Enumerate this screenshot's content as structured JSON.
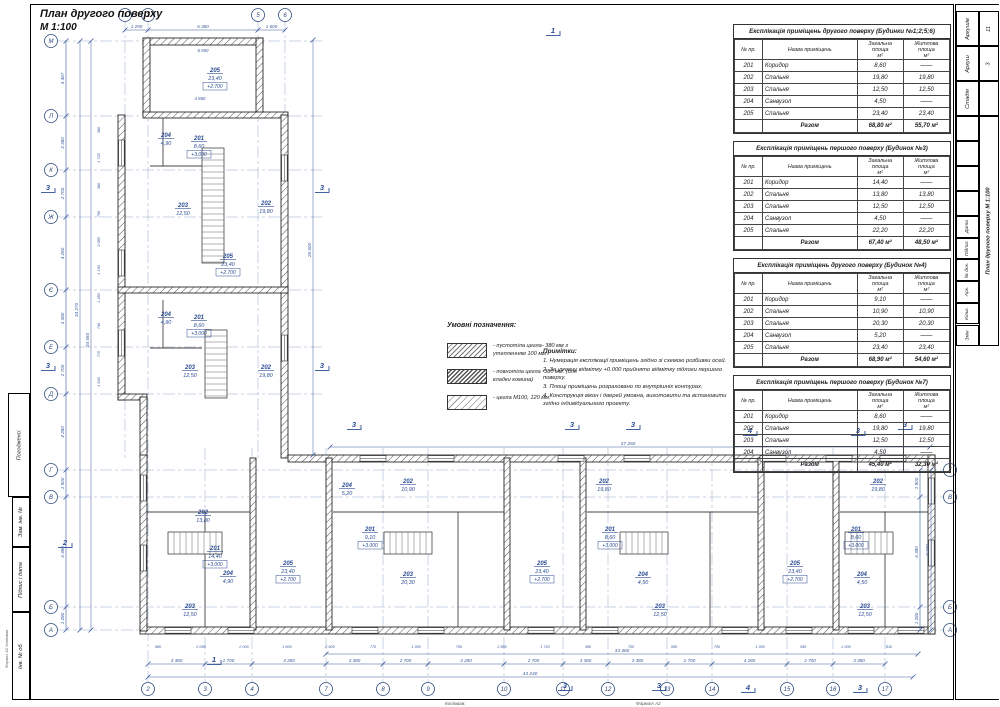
{
  "sheet": {
    "title": "План другого поверху",
    "scale": "М 1:100"
  },
  "accent_colors": {
    "annotation_blue": "#3a5b9e",
    "wall_black": "#111111"
  },
  "tables": [
    {
      "title": "Експлікація приміщень другого поверху (Будинки №1;2;5;6)",
      "headers": [
        "№ пр.",
        "Назва приміщень",
        "Загальна площа\nм²",
        "Житлова площа\nм²"
      ],
      "rows": [
        [
          "201",
          "Коридор",
          "8,60",
          "——"
        ],
        [
          "202",
          "Спальня",
          "19,80",
          "19,80"
        ],
        [
          "203",
          "Спальня",
          "12,50",
          "12,50"
        ],
        [
          "204",
          "Санвузол",
          "4,50",
          "——"
        ],
        [
          "205",
          "Спальня",
          "23,40",
          "23,40"
        ]
      ],
      "total": [
        "",
        "Разом",
        "68,80 м²",
        "55,70 м²"
      ]
    },
    {
      "title": "Експлікація приміщень першого поверху (Будинок №3)",
      "headers": [
        "№ пр.",
        "Назва приміщень",
        "Загальна площа\nм²",
        "Житлова площа\nм²"
      ],
      "rows": [
        [
          "201",
          "Коридор",
          "14,40",
          "——"
        ],
        [
          "202",
          "Спальня",
          "13,80",
          "13,80"
        ],
        [
          "203",
          "Спальня",
          "12,50",
          "12,50"
        ],
        [
          "204",
          "Санвузол",
          "4,50",
          "——"
        ],
        [
          "205",
          "Спальня",
          "22,20",
          "22,20"
        ]
      ],
      "total": [
        "",
        "Разом",
        "67,40 м²",
        "48,50 м²"
      ]
    },
    {
      "title": "Експлікація приміщень другого поверху (Будинок №4)",
      "headers": [
        "№ пр.",
        "Назва приміщень",
        "Загальна площа\nм²",
        "Житлова площа\nм²"
      ],
      "rows": [
        [
          "201",
          "Коридор",
          "9,10",
          "——"
        ],
        [
          "202",
          "Спальня",
          "10,90",
          "10,90"
        ],
        [
          "203",
          "Спальня",
          "20,30",
          "20,30"
        ],
        [
          "204",
          "Санвузол",
          "5,20",
          "——"
        ],
        [
          "205",
          "Спальня",
          "23,40",
          "23,40"
        ]
      ],
      "total": [
        "",
        "Разом",
        "68,90 м²",
        "54,60 м²"
      ]
    },
    {
      "title": "Експлікація приміщень першого поверху (Будинок №7)",
      "headers": [
        "№ пр.",
        "Назва приміщень",
        "Загальна площа\nм²",
        "Житлова площа\nм²"
      ],
      "rows": [
        [
          "201",
          "Коридор",
          "8,60",
          "——"
        ],
        [
          "202",
          "Спальня",
          "19,80",
          "19,80"
        ],
        [
          "203",
          "Спальня",
          "12,50",
          "12,50"
        ],
        [
          "204",
          "Санвузол",
          "4,50",
          "——"
        ]
      ],
      "total": [
        "",
        "Разом",
        "45,40 м²",
        "32,30 м²"
      ]
    }
  ],
  "legend": {
    "title": "Умовні позначення:",
    "items": [
      "- пустотіла цегла- 380 мм з утепленням 100 мм",
      "- повнотіла цегла -380 мм. (для кладки комина)",
      "- цегла М100, 120 мм."
    ]
  },
  "notes": {
    "title": "Примітки:",
    "items": [
      "1. Нумерація експлікації приміщень згідно зі схемою розбивки осей.",
      "2. За умовну відмітку +0.000 прийнято відмітку підлоги першого поверху.",
      "3. Площі приміщень розраховано по внутрішніх контурах.",
      "4. Конструкція вікон і дверей умовна, виготовити та встановити згідно індивідуального проекту."
    ]
  },
  "titleblock_right": {
    "stage_label": "Стадія",
    "sheet_label": "Аркуш",
    "sheets_label": "Аркушів",
    "stage": "",
    "sheet": "3",
    "sheets": "11",
    "title": "План другого поверху  М 1:100",
    "cols": [
      "Дата",
      "Підпис",
      "№ док.",
      "Арк.",
      "Кільк.",
      "Змін"
    ]
  },
  "titleblock_left": {
    "approved": "Погоджено:",
    "zam_inv": "Зам. інв. №",
    "sign_date": "Підпис і дата",
    "inv_ob": "Інв. № об.",
    "format_note": "Формат А2    Копіював"
  },
  "footer": {
    "copied": "Копіював:",
    "format": "Формат А2"
  },
  "plan": {
    "bubbles_top": [
      [
        "1",
        125
      ],
      [
        "2",
        148
      ],
      [
        "5",
        258
      ],
      [
        "6",
        285
      ]
    ],
    "bubbles_bottom": [
      [
        "2",
        148
      ],
      [
        "3",
        205
      ],
      [
        "4",
        252
      ],
      [
        "7",
        326
      ],
      [
        "8",
        383
      ],
      [
        "9",
        428
      ],
      [
        "10",
        504
      ],
      [
        "11",
        563
      ],
      [
        "12",
        608
      ],
      [
        "13",
        667
      ],
      [
        "14",
        712
      ],
      [
        "15",
        787
      ],
      [
        "16",
        833
      ],
      [
        "17",
        885
      ]
    ],
    "bubbles_left": [
      [
        "М",
        41
      ],
      [
        "Л",
        116
      ],
      [
        "К",
        170
      ],
      [
        "Ж",
        217
      ],
      [
        "Є",
        290
      ],
      [
        "Е",
        347
      ],
      [
        "Д",
        394
      ],
      [
        "Г",
        470
      ],
      [
        "В",
        497
      ],
      [
        "Б",
        607
      ],
      [
        "А",
        630
      ]
    ],
    "bubbles_right": [
      [
        "Г",
        470
      ],
      [
        "В",
        497
      ],
      [
        "Б",
        607
      ],
      [
        "А",
        630
      ]
    ],
    "dims_top": {
      "y": 30,
      "ticks": [
        125,
        148,
        258,
        285
      ],
      "labels": [
        "1 290",
        "6 380",
        "1 600"
      ]
    },
    "dims_inner": [
      [
        "6 000",
        203,
        52
      ],
      [
        "4 860",
        200,
        100
      ]
    ],
    "dims_bottom": {
      "y": 664,
      "labels": [
        "3 380",
        "2 700",
        "4 280",
        "3 380",
        "2 700",
        "4 280",
        "2 700",
        "3 380",
        "3 380",
        "2 700",
        "4 280",
        "2 700",
        "3 380"
      ]
    },
    "totals_bottom": [
      {
        "t": "33 460",
        "y": 654,
        "x1": 326,
        "x2": 918,
        "lx": 622
      },
      {
        "t": "43 240",
        "y": 677,
        "x1": 148,
        "x2": 913,
        "lx": 530
      }
    ],
    "dim_wing_top": {
      "t": "37 260",
      "y": 447,
      "x1": 330,
      "x2": 930,
      "lx": 628
    },
    "dims_left": {
      "x": 66,
      "labels": [
        "4 467",
        "3 380",
        "2 700",
        "4 280",
        "3 380",
        "2 700",
        "4 280",
        "1 900",
        "6 380",
        "1 280"
      ]
    },
    "totals_left": [
      [
        "34 270",
        80,
        310
      ],
      [
        "34 650",
        91,
        340
      ]
    ],
    "dims_right": {
      "x": 920,
      "ticks": [
        470,
        497,
        607,
        630
      ],
      "labels": [
        "1 900",
        "6 380",
        "1 280"
      ]
    },
    "total_right": [
      "9 270",
      931,
      550
    ],
    "dim_wing_right": [
      "26 600",
      313,
      250
    ],
    "small_left": [
      "380",
      "1 720",
      "380",
      "700",
      "3 080",
      "1 190",
      "1 280",
      "740",
      "770",
      "1 540"
    ],
    "small_bottom": [
      "980",
      "2 080",
      "2 000",
      "1 600",
      "2 900",
      "770",
      "1 360",
      "700",
      "2 580",
      "1 720",
      "380",
      "700",
      "550",
      "700",
      "1 360",
      "390",
      "2 000",
      "810"
    ],
    "rooms": [
      [
        215,
        72,
        "205",
        "23,40",
        "+2.700"
      ],
      [
        166,
        137,
        "204",
        "4,90",
        null
      ],
      [
        199,
        140,
        "201",
        "8,60",
        "+3.000"
      ],
      [
        183,
        207,
        "203",
        "12,50",
        null
      ],
      [
        266,
        205,
        "202",
        "19,80",
        null
      ],
      [
        228,
        258,
        "205",
        "23,40",
        "+2.700"
      ],
      [
        166,
        316,
        "204",
        "4,90",
        null
      ],
      [
        199,
        319,
        "201",
        "8,60",
        "+3.000"
      ],
      [
        190,
        369,
        "203",
        "12,50",
        null
      ],
      [
        266,
        369,
        "202",
        "19,80",
        null
      ],
      [
        203,
        514,
        "202",
        "13,80",
        null
      ],
      [
        215,
        550,
        "201",
        "14,40",
        "+3.000"
      ],
      [
        228,
        575,
        "204",
        "4,90",
        null
      ],
      [
        190,
        608,
        "203",
        "12,50",
        null
      ],
      [
        288,
        565,
        "205",
        "23,40",
        "+2.700"
      ],
      [
        347,
        487,
        "204",
        "5,20",
        null
      ],
      [
        408,
        483,
        "202",
        "10,90",
        null
      ],
      [
        370,
        531,
        "201",
        "9,10",
        "+3.000"
      ],
      [
        408,
        576,
        "203",
        "20,30",
        null
      ],
      [
        542,
        565,
        "205",
        "23,40",
        "+2.700"
      ],
      [
        604,
        483,
        "202",
        "19,80",
        null
      ],
      [
        610,
        531,
        "201",
        "8,60",
        "+3.000"
      ],
      [
        643,
        576,
        "204",
        "4,50",
        null
      ],
      [
        660,
        608,
        "203",
        "12,50",
        null
      ],
      [
        795,
        565,
        "205",
        "23,40",
        "+2.700"
      ],
      [
        878,
        483,
        "202",
        "19,80",
        null
      ],
      [
        856,
        531,
        "201",
        "8,60",
        "+3.000"
      ],
      [
        862,
        576,
        "204",
        "4,50",
        null
      ],
      [
        865,
        608,
        "203",
        "12,50",
        null
      ]
    ],
    "sections": [
      [
        "1",
        553,
        33
      ],
      [
        "3",
        48,
        190
      ],
      [
        "3",
        322,
        190
      ],
      [
        "3",
        48,
        368
      ],
      [
        "3",
        322,
        368
      ],
      [
        "3",
        354,
        427
      ],
      [
        "3",
        572,
        427
      ],
      [
        "3",
        633,
        427
      ],
      [
        "3",
        905,
        427
      ],
      [
        "2",
        65,
        545
      ],
      [
        "1",
        214,
        662
      ],
      [
        "3",
        565,
        688
      ],
      [
        "3",
        659,
        688
      ],
      [
        "4",
        748,
        690
      ],
      [
        "3",
        860,
        690
      ],
      [
        "4",
        750,
        433
      ],
      [
        "3",
        858,
        433
      ]
    ]
  }
}
